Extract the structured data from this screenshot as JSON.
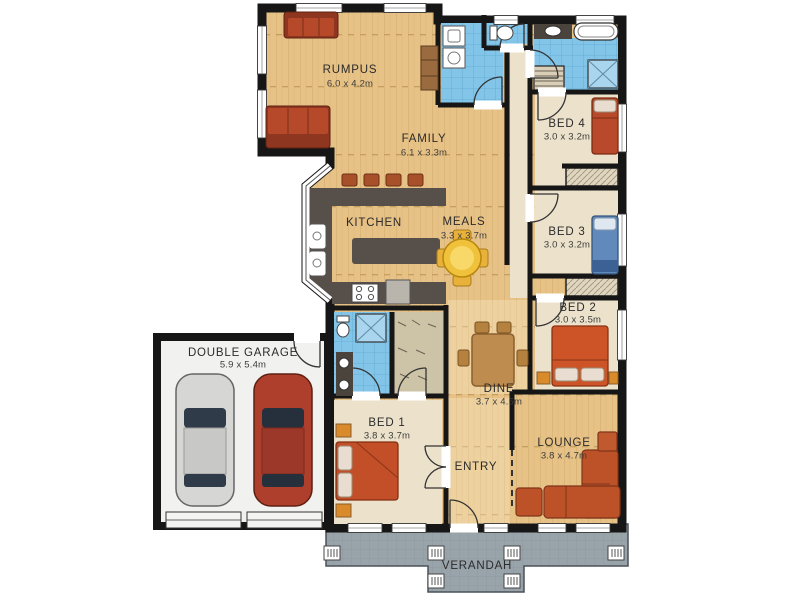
{
  "plan_type": "residential floor plan",
  "palette": {
    "wall": "#161616",
    "wood_floor": "#e7c286",
    "carpet": "#ece2cb",
    "tile_blue": "#82c5e9",
    "bench_dark": "#57504a",
    "garage_floor": "#f1f1ef",
    "verandah_grey": "#99a3aa",
    "sofa_red": "#b5492a",
    "bed_orange": "#cc5427",
    "bed_blue": "#6189bb",
    "table_yellow": "#f0c23c",
    "car_silver": "#d6d6d4",
    "car_red": "#ad3f2c"
  },
  "rooms": {
    "rumpus": {
      "name": "RUMPUS",
      "dims": "6.0 x 4.2m"
    },
    "family": {
      "name": "FAMILY",
      "dims": "6.1 x 3.3m"
    },
    "kitchen": {
      "name": "KITCHEN",
      "dims": ""
    },
    "meals": {
      "name": "MEALS",
      "dims": "3.3 x 3.7m"
    },
    "bed4": {
      "name": "BED 4",
      "dims": "3.0 x 3.2m"
    },
    "bed3": {
      "name": "BED 3",
      "dims": "3.0 x 3.2m"
    },
    "bed2": {
      "name": "BED 2",
      "dims": "3.0 x 3.5m"
    },
    "bed1": {
      "name": "BED 1",
      "dims": "3.8 x 3.7m"
    },
    "dine": {
      "name": "DINE",
      "dims": "3.7 x 4.5m"
    },
    "lounge": {
      "name": "LOUNGE",
      "dims": "3.8 x 4.7m"
    },
    "entry": {
      "name": "ENTRY",
      "dims": ""
    },
    "garage": {
      "name": "DOUBLE GARAGE",
      "dims": "5.9 x 5.4m"
    },
    "verandah": {
      "name": "VERANDAH",
      "dims": ""
    }
  }
}
